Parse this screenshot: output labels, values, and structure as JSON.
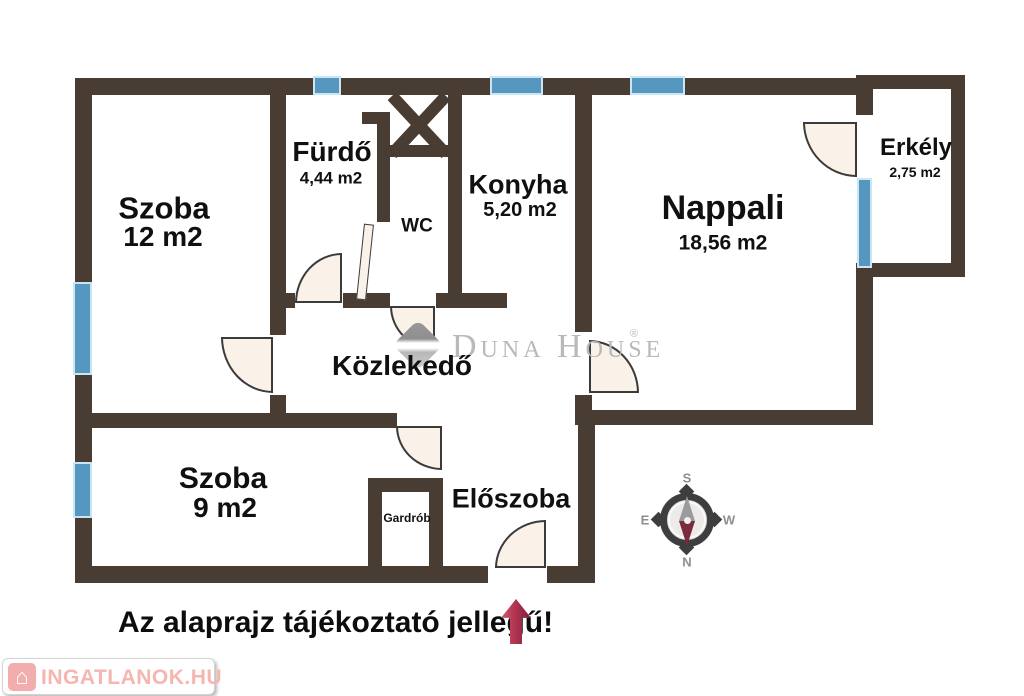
{
  "rooms": {
    "szoba12": {
      "name": "Szoba",
      "area": "12 m2"
    },
    "furdo": {
      "name": "Fürdő",
      "area": "4,44 m2"
    },
    "wc": {
      "name": "WC"
    },
    "konyha": {
      "name": "Konyha",
      "area": "5,20 m2"
    },
    "nappali": {
      "name": "Nappali",
      "area": "18,56 m2"
    },
    "erkely": {
      "name": "Erkély",
      "area": "2,75 m2"
    },
    "kozlekedo": {
      "name": "Közlekedő"
    },
    "szoba9": {
      "name": "Szoba",
      "area": "9 m2"
    },
    "gardrob": {
      "name": "Gardrób"
    },
    "eloszoba": {
      "name": "Előszoba"
    }
  },
  "watermark": {
    "text": "Duna House",
    "registered": "®"
  },
  "compass": {
    "top": "S",
    "bottom": "N",
    "left": "E",
    "right": "W"
  },
  "disclaimer": "Az alaprajz tájékoztató jellegű!",
  "site_logo": {
    "text": "INGATLANOK.HU",
    "house_icon": "⌂"
  },
  "colors": {
    "wall": "#483c33",
    "window_blue": "#5697bf",
    "window_glow": "#cae6f2",
    "door_fill": "#faf2e9",
    "arrow_red": "#8e2038",
    "logo_pink": "#f5b6b0",
    "watermark_gray": "#b9b9b9",
    "compass_dark": "#3e3e3e",
    "needle_red": "#7c2b3d"
  }
}
